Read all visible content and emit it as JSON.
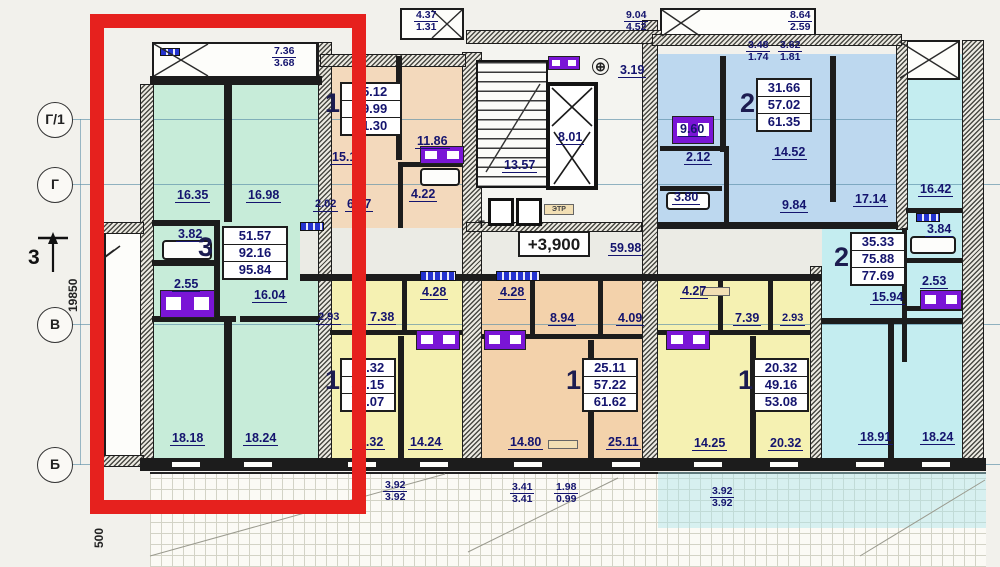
{
  "colors": {
    "highlight": "#e6211e",
    "apt_green": "#c7ecd9",
    "apt_peach": "#f3d9bc",
    "apt_blue": "#bdd8ef",
    "apt_cyan": "#c4edf0",
    "apt_yellow": "#f5f1b2",
    "apt_orange": "#f3d2ab",
    "dim_text": "#14146e"
  },
  "axes": {
    "rows": [
      "Г/1",
      "Г",
      "В",
      "Б"
    ],
    "section_mark": "3",
    "height_dim": "19850",
    "offset_dim": "500"
  },
  "top_dims": {
    "balcony_a": {
      "num": "4.37",
      "den": "1.31"
    },
    "balcony_b": {
      "num": "9.04",
      "den": "4.52"
    },
    "balcony_c": {
      "num": "8.64",
      "den": "2.59"
    },
    "balcony_d": {
      "num": "3.48",
      "den": "1.74"
    },
    "balcony_e": {
      "num": "3.62",
      "den": "1.81"
    }
  },
  "bottom_dims": {
    "terrace_a": {
      "num": "3.92",
      "den": "3.92"
    },
    "terrace_b": {
      "num": "3.41",
      "den": "3.41"
    },
    "terrace_c": {
      "num": "1.98",
      "den": "0.99"
    },
    "terrace_d": {
      "num": "3.92",
      "den": "3.92"
    }
  },
  "core": {
    "stairs": "13.57",
    "elevator": "8.01",
    "lobby": "3.19",
    "corridor": "59.98",
    "level_mark": "+3,900",
    "etr": "ЭТР",
    "chute": "Т"
  },
  "apartments": {
    "apt3": {
      "number": "3",
      "areas": [
        "51.57",
        "92.16",
        "95.84"
      ],
      "balcony": {
        "num": "7.36",
        "den": "3.68"
      },
      "rooms": {
        "room1": "16.35",
        "room2": "16.98",
        "bath": "3.82",
        "wc": "2.55",
        "hall": "16.04",
        "room3": "18.18",
        "room4": "18.24"
      }
    },
    "apt1a": {
      "number": "1",
      "areas": [
        "15.12",
        "39.99",
        "41.30"
      ],
      "rooms": {
        "room": "15.12",
        "kitchen": "11.86",
        "hall": "6.77",
        "wc": "2.02",
        "bath": "4.22"
      }
    },
    "apt2a": {
      "number": "2",
      "areas": [
        "31.66",
        "57.02",
        "61.35"
      ],
      "rooms": {
        "kitchen": "9.60",
        "wc": "2.12",
        "bath": "3.80",
        "room1": "14.52",
        "hall": "9.84",
        "room2": "17.14"
      }
    },
    "apt2b": {
      "number": "2",
      "areas": [
        "35.33",
        "75.88",
        "77.69"
      ],
      "rooms": {
        "room1": "16.42",
        "bath": "3.84",
        "wc": "2.53",
        "hall": "15.94",
        "room2": "18.91",
        "room3": "18.24"
      }
    },
    "apt1b": {
      "number": "1",
      "areas": [
        "17.32",
        "46.15",
        "50.07"
      ],
      "rooms": {
        "wc": "2.93",
        "hall": "7.38",
        "bath": "4.28",
        "kitchen": "14.24",
        "room": "17.32"
      }
    },
    "apt1c": {
      "number": "1",
      "areas": [
        "25.11",
        "57.22",
        "61.62"
      ],
      "rooms": {
        "bath": "4.28",
        "hall": "8.94",
        "wc": "4.09",
        "kitchen": "14.80",
        "room": "25.11"
      }
    },
    "apt1d": {
      "number": "1",
      "areas": [
        "20.32",
        "49.16",
        "53.08"
      ],
      "rooms": {
        "bath": "4.27",
        "hall": "7.39",
        "wc": "2.93",
        "kitchen": "14.25",
        "room": "20.32"
      }
    }
  }
}
